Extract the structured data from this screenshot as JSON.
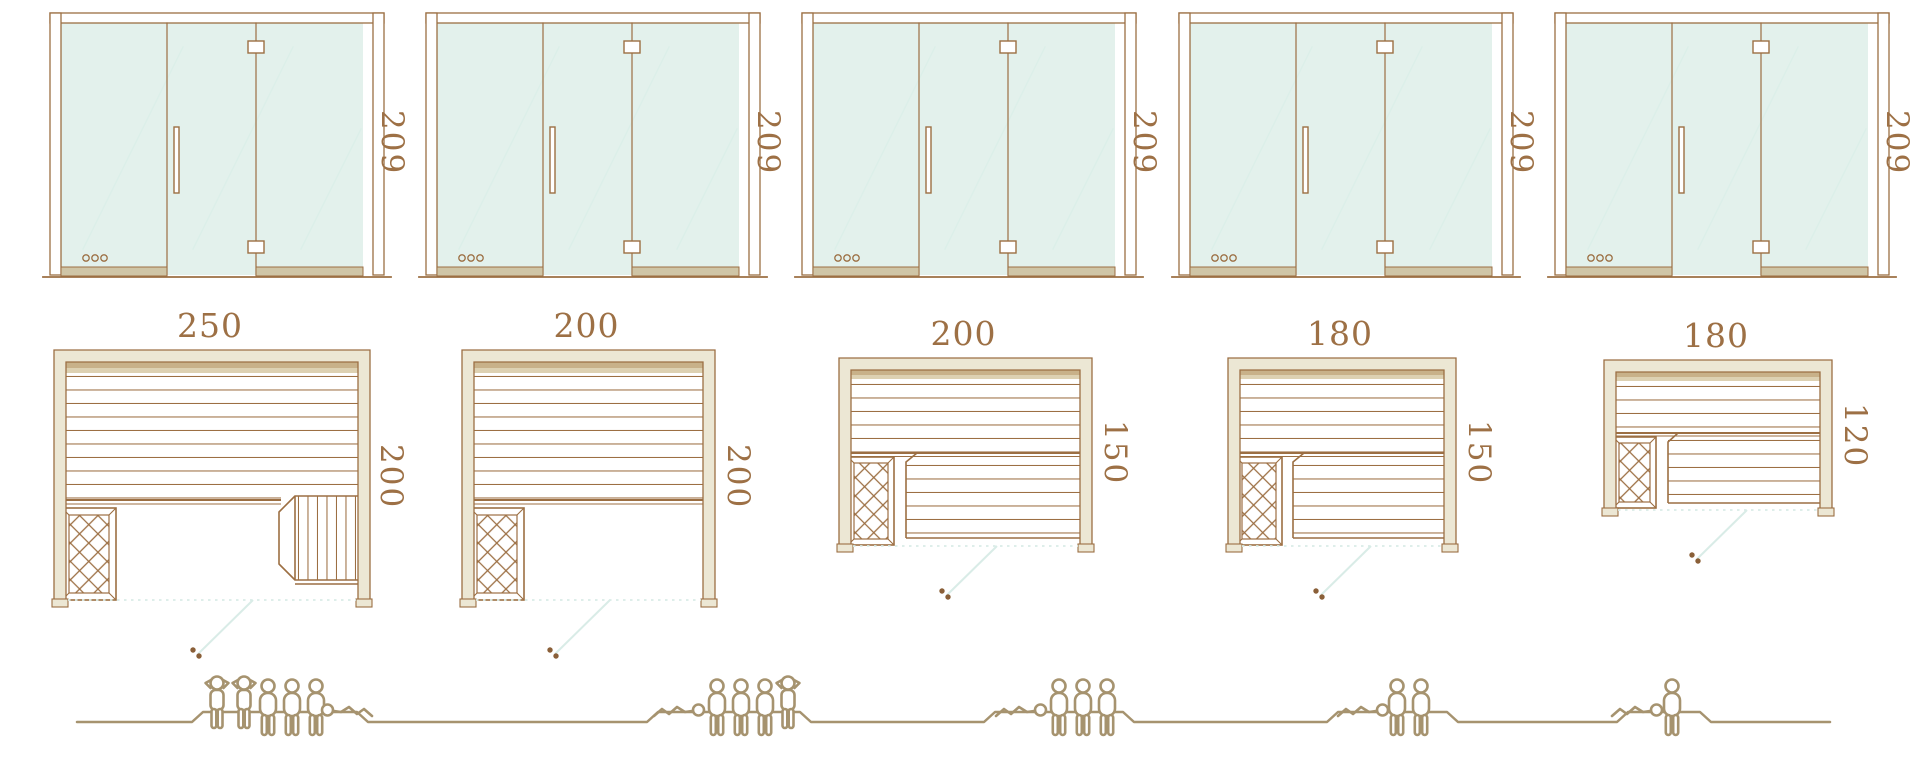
{
  "diagram_title": "",
  "colors": {
    "line_brown": "#9c6f43",
    "label_text": "#9d7045",
    "wall_fill": "#ece7d4",
    "wall_shade_dark": "#c8b189",
    "wall_shade_light": "#ddd1b2",
    "glass": "#e3f1ec",
    "glass_rail": "#cfc5a6",
    "door_swing_mint": "#d9ece7",
    "swing_handle_dot": "#8a5f38",
    "people_outline": "#a6936f"
  },
  "units": [
    {
      "name": "sauna-unit-1",
      "door": {
        "height": "209",
        "features": [
          "glass-panels",
          "vertical-handle",
          "hinges",
          "vent-holes"
        ]
      },
      "plan": {
        "width": "250",
        "depth": "200",
        "features": [
          "bench-slats",
          "heater-crosshatch",
          "side-bench",
          "door-swing"
        ]
      },
      "people": [
        "standing",
        "standing",
        "sitting",
        "sitting",
        "sitting",
        "lying"
      ],
      "capacity": 6
    },
    {
      "name": "sauna-unit-2",
      "door": {
        "height": "209",
        "features": [
          "glass-panels",
          "vertical-handle",
          "hinges",
          "vent-holes"
        ]
      },
      "plan": {
        "width": "200",
        "depth": "200",
        "features": [
          "bench-slats",
          "heater-crosshatch",
          "door-swing"
        ]
      },
      "people": [
        "lying",
        "sitting",
        "sitting",
        "sitting",
        "standing"
      ],
      "capacity": 5
    },
    {
      "name": "sauna-unit-3",
      "door": {
        "height": "209",
        "features": [
          "glass-panels",
          "vertical-handle",
          "hinges",
          "vent-holes"
        ]
      },
      "plan": {
        "width": "200",
        "depth": "150",
        "features": [
          "bench-slats",
          "heater-crosshatch",
          "lower-bench",
          "door-swing"
        ]
      },
      "people": [
        "lying",
        "sitting",
        "sitting",
        "sitting"
      ],
      "capacity": 4
    },
    {
      "name": "sauna-unit-4",
      "door": {
        "height": "209",
        "features": [
          "glass-panels",
          "vertical-handle",
          "hinges",
          "vent-holes"
        ]
      },
      "plan": {
        "width": "180",
        "depth": "150",
        "features": [
          "bench-slats",
          "heater-crosshatch",
          "lower-bench",
          "door-swing"
        ]
      },
      "people": [
        "lying",
        "sitting",
        "sitting"
      ],
      "capacity": 3
    },
    {
      "name": "sauna-unit-5",
      "door": {
        "height": "209",
        "features": [
          "glass-panels",
          "vertical-handle",
          "hinges",
          "vent-holes"
        ]
      },
      "plan": {
        "width": "180",
        "depth": "120",
        "features": [
          "bench-slats",
          "heater-crosshatch",
          "lower-bench",
          "door-swing"
        ]
      },
      "people": [
        "lying",
        "sitting"
      ],
      "capacity": 2
    }
  ],
  "icons": {
    "standing": "person-standing-icon",
    "sitting": "person-sitting-icon",
    "lying": "person-lying-icon",
    "heater": "heater-crosshatch-icon",
    "door_swing": "door-swing-arc"
  }
}
